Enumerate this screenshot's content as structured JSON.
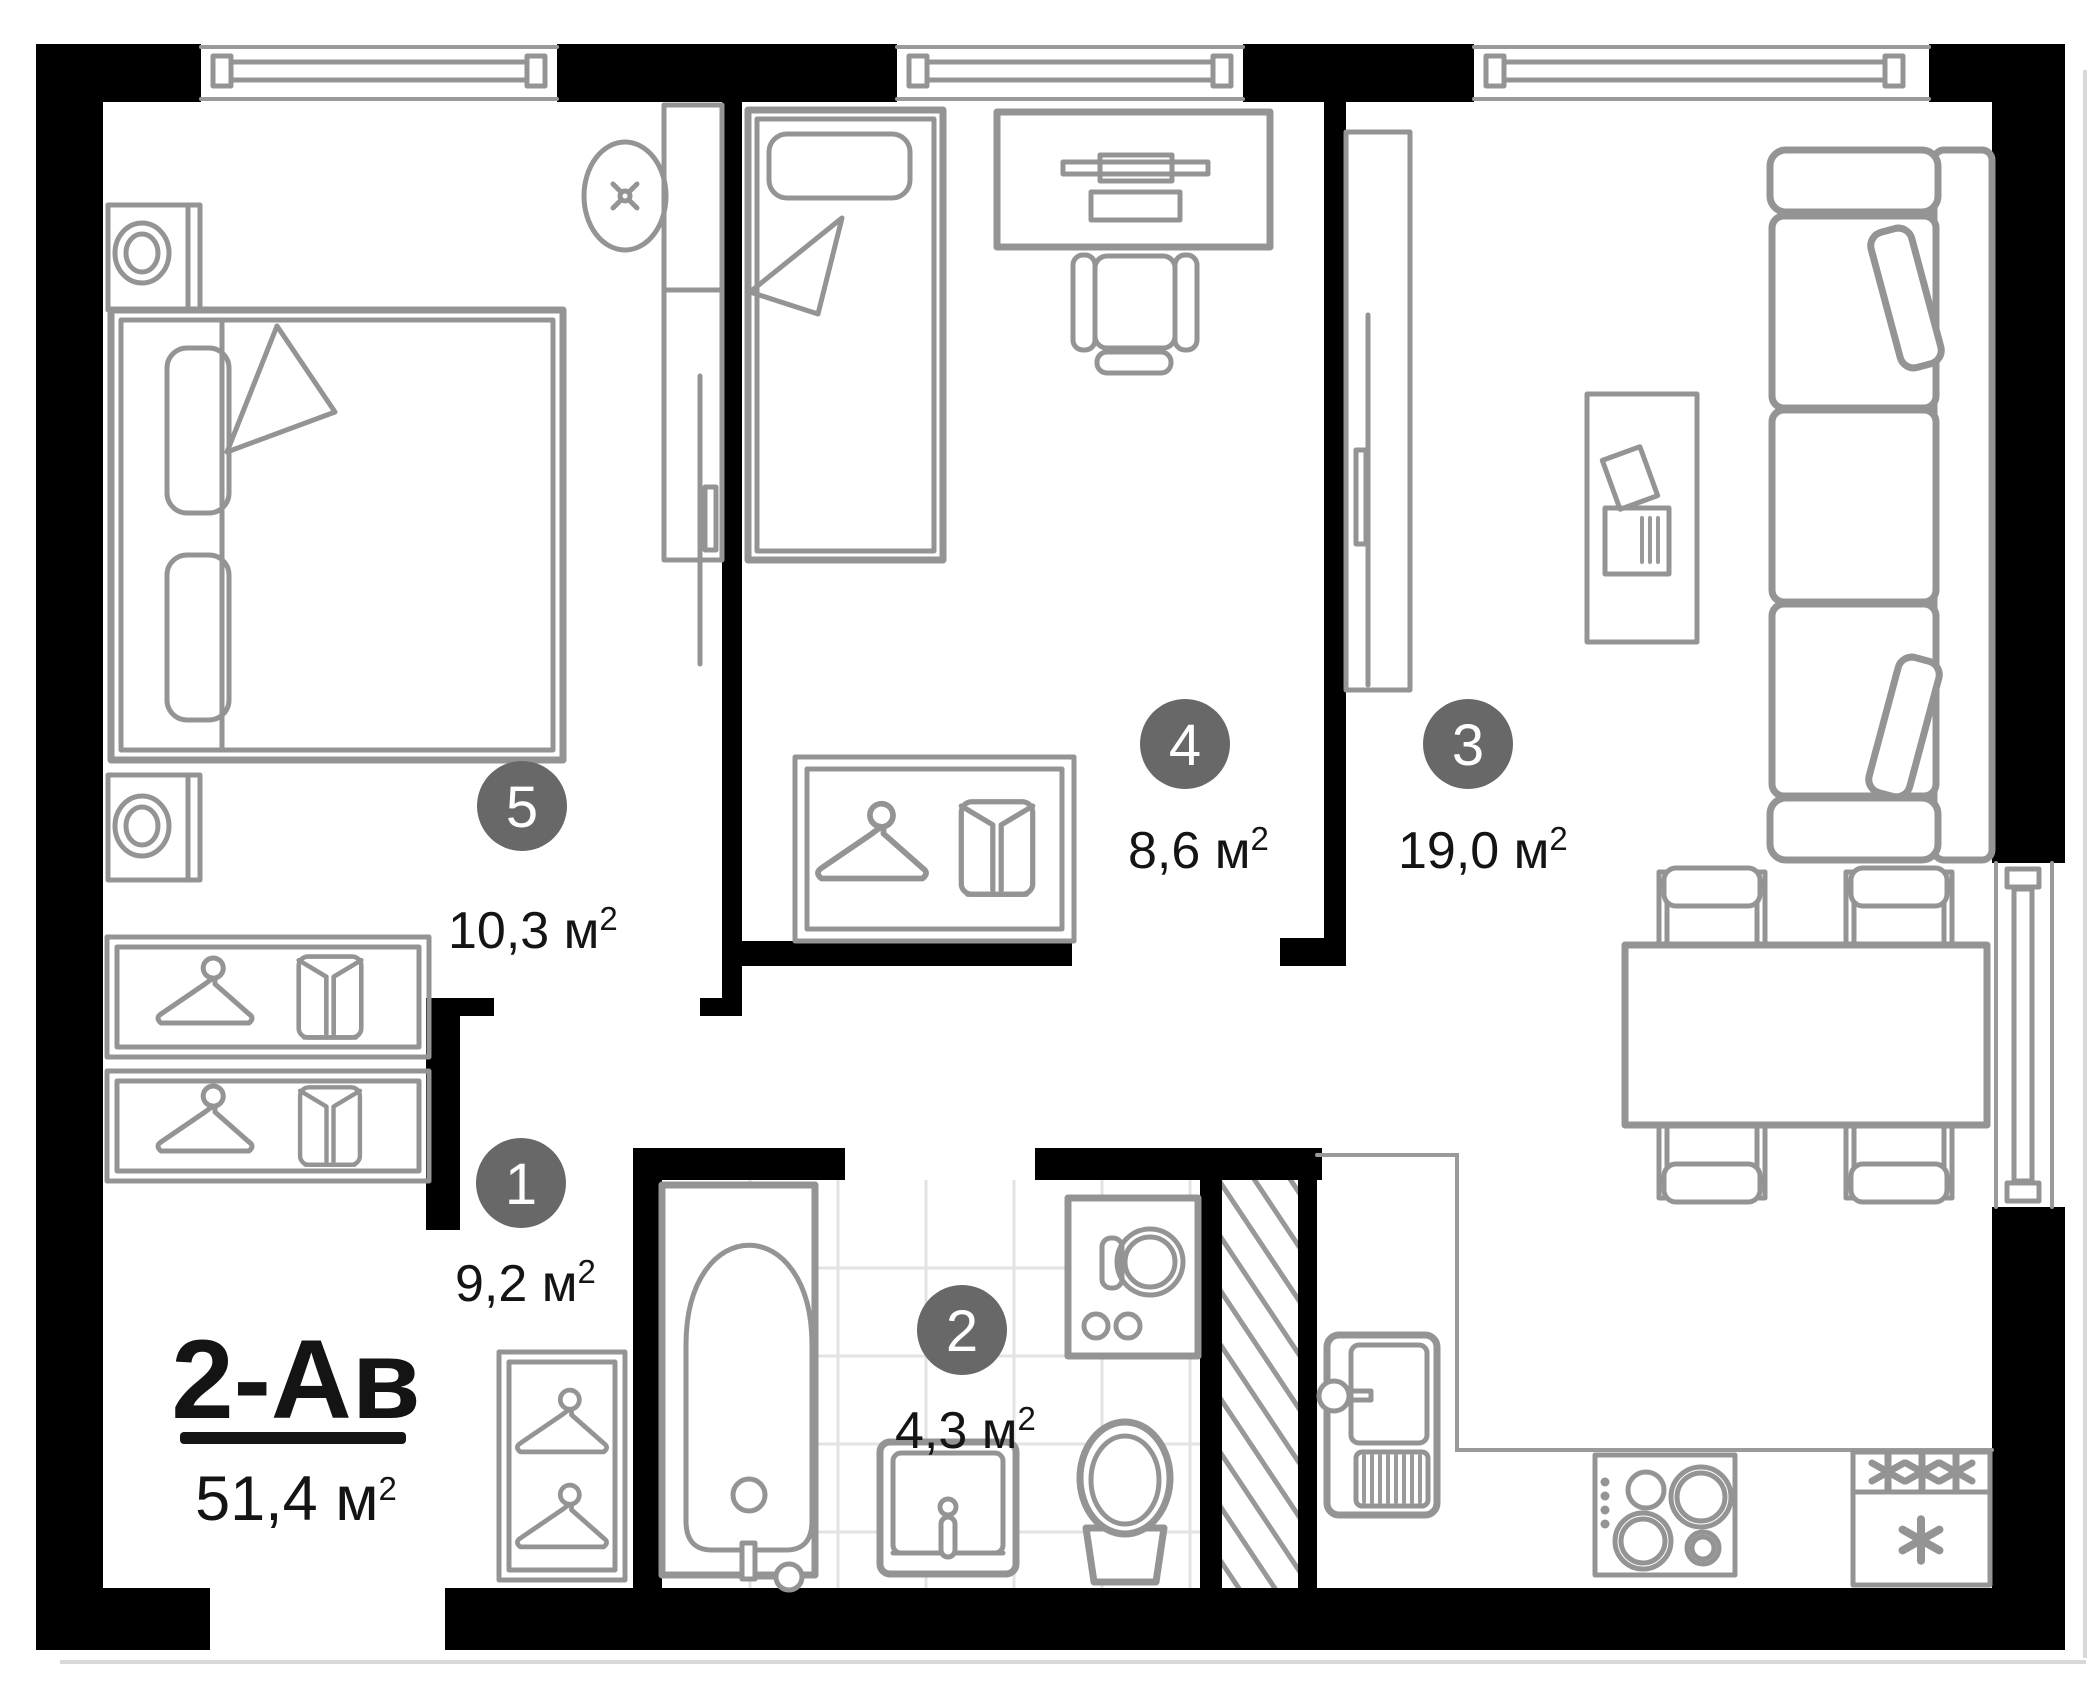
{
  "plan": {
    "type": "apartment-floor-plan",
    "title": {
      "code": "2-Ав",
      "area_value": "51,4",
      "unit_base": " м",
      "unit_sup": "2"
    },
    "rooms": [
      {
        "key": "hallway",
        "number": "1",
        "area_value": "9,2",
        "unit_base": " м",
        "unit_sup": "2"
      },
      {
        "key": "bathroom",
        "number": "2",
        "area_value": "4,3",
        "unit_base": " м",
        "unit_sup": "2"
      },
      {
        "key": "living-kitchen",
        "number": "3",
        "area_value": "19,0",
        "unit_base": " м",
        "unit_sup": "2"
      },
      {
        "key": "bedroom-small",
        "number": "4",
        "area_value": "8,6",
        "unit_base": " м",
        "unit_sup": "2"
      },
      {
        "key": "bedroom-master",
        "number": "5",
        "area_value": "10,3",
        "unit_base": " м",
        "unit_sup": "2"
      }
    ],
    "colors": {
      "wall": "#000000",
      "furniture_line": "#949494",
      "room_badge": "#686868",
      "text": "#141414",
      "tile_line": "#e3e3e3"
    },
    "icons": {
      "freezer_symbol": "✳",
      "ceiling_light": "✕",
      "hanger": "clothes-hanger",
      "shirt": "folded-shirt"
    }
  }
}
